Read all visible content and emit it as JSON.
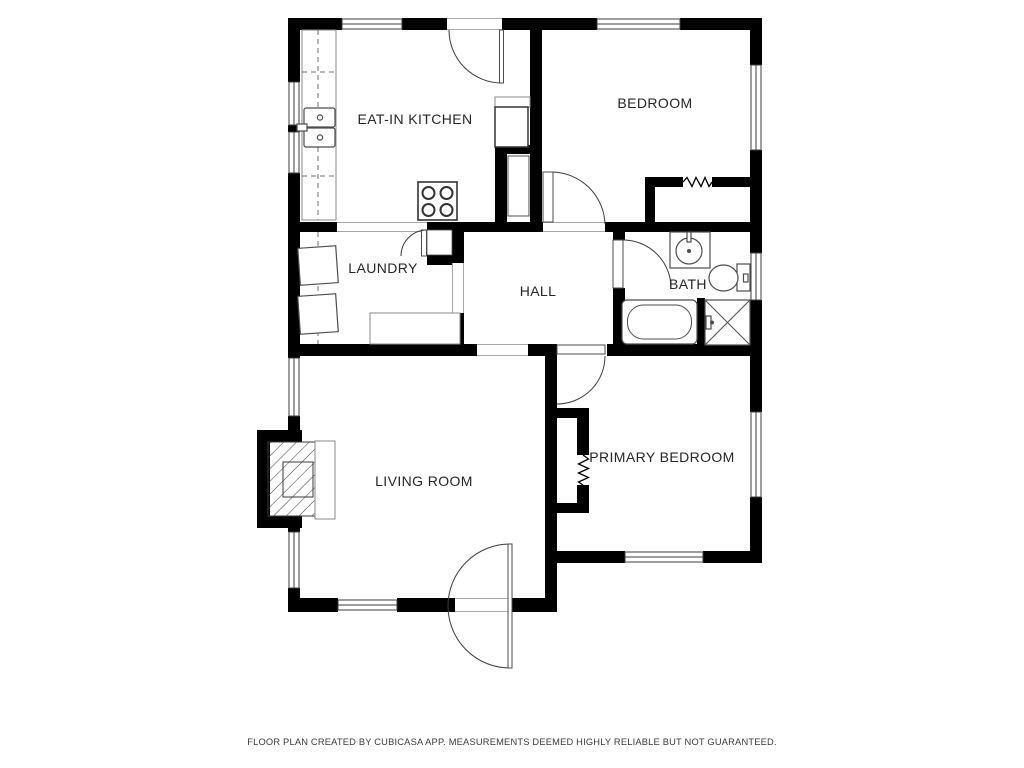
{
  "rooms": [
    {
      "name": "EAT-IN KITCHEN"
    },
    {
      "name": "BEDROOM"
    },
    {
      "name": "LAUNDRY"
    },
    {
      "name": "HALL"
    },
    {
      "name": "BATH"
    },
    {
      "name": "LIVING ROOM"
    },
    {
      "name": "PRIMARY BEDROOM"
    }
  ],
  "footer": "FLOOR PLAN CREATED BY CUBICASA APP. MEASUREMENTS DEEMED HIGHLY RELIABLE BUT NOT GUARANTEED.",
  "colors": {
    "wall": "#000000",
    "background": "#ffffff",
    "label": "#262626",
    "fixture_stroke": "#4d4d4d"
  },
  "fixtures": [
    "kitchen-sink",
    "stove",
    "refrigerator",
    "kitchen-counter",
    "washer",
    "dryer",
    "laundry-counter",
    "bathroom-sink",
    "toilet",
    "bathtub",
    "shower",
    "fireplace",
    "closet-sliding-door",
    "door-swing",
    "window"
  ]
}
